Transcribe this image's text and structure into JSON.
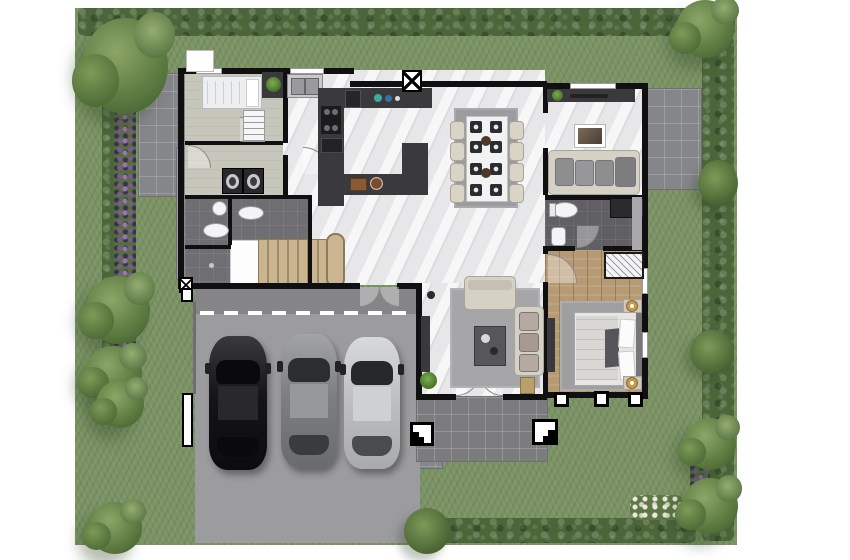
{
  "scene": {
    "type": "architectural-floor-plan",
    "view": "top-down",
    "description": "Rendered ground-floor plan of a detached house on a landscaped lawn plot with hedged borders, two stone patios, an entry porch and a three-car carport with driveway"
  },
  "palette": {
    "lawn": "#7b9364",
    "hedge": "#4b673a",
    "tree": "#5f7d43",
    "flowers_purple": "#7b5a8c",
    "flowers_white": "#e8e8e8",
    "wall": "#101012",
    "marble_floor": "#e7e7e9",
    "service_floor": "#c6c7ba",
    "bath_floor": "#6f6f73",
    "wood_floor": "#b59a74",
    "counter_dark": "#3a3a3d",
    "stairs": "#c9b58f",
    "garage": "#9c9c9f",
    "garage_inner": "#858588",
    "porch": "#7c7c7f",
    "rug": "#a6a6a9",
    "sofa_beige": "#d6d1c5",
    "cushion_gray": "#8e8e91",
    "car_black": "#1a1a1c",
    "car_gray": "#8a8b8d",
    "car_silver": "#c7c8ca",
    "plant_green": "#5d8f35",
    "lamp_gold": "#c59a4c",
    "dining_table": "#f2f2f3",
    "placemat": "#2c2c30"
  },
  "rooms": [
    {
      "id": "single-bedroom",
      "label": "Single bedroom",
      "features": [
        "single-bed",
        "shelf-unit",
        "dresser",
        "plant"
      ]
    },
    {
      "id": "laundry",
      "label": "Laundry room",
      "features": [
        "washing-machine",
        "washing-machine"
      ]
    },
    {
      "id": "bathroom",
      "label": "Bathroom",
      "features": [
        "round-basin",
        "toilet",
        "vanity-basin",
        "floor-drain"
      ]
    },
    {
      "id": "kitchen",
      "label": "Kitchen",
      "features": [
        "double-sink",
        "cooktop",
        "oven",
        "refrigerator",
        "appliance-counter",
        "island-counter",
        "food-trays"
      ]
    },
    {
      "id": "dining-area",
      "label": "Dining area",
      "features": [
        "eight-seat-table",
        "8-placemats",
        "2-centerpieces",
        "rug"
      ]
    },
    {
      "id": "tv-lounge",
      "label": "TV lounge",
      "features": [
        "console-shelf",
        "plant",
        "wall-art",
        "sofa-with-cushions"
      ]
    },
    {
      "id": "ensuite-bathroom",
      "label": "En-suite bathroom",
      "features": [
        "toilet",
        "basin",
        "shower"
      ]
    },
    {
      "id": "master-bedroom",
      "label": "Master bedroom",
      "features": [
        "double-bed",
        "pillows",
        "rug",
        "2-nightstand-lamps",
        "clothes-rack",
        "tv-console"
      ]
    },
    {
      "id": "living-room",
      "label": "Living room",
      "features": [
        "loveseat",
        "side-sofa",
        "coffee-table",
        "tv-console",
        "plant",
        "basket",
        "floor-lamp"
      ]
    },
    {
      "id": "staircase",
      "label": "Staircase",
      "features": [
        "landing",
        "treads",
        "curved-handrail"
      ]
    },
    {
      "id": "foyer-porch",
      "label": "Entry porch",
      "features": [
        "double-door",
        "step-marker-left",
        "step-marker-right",
        "porch-columns"
      ]
    },
    {
      "id": "carport",
      "label": "Carport & driveway",
      "features": [
        "garage-threshold",
        "black-car",
        "gray-car",
        "silver-car",
        "gate-posts"
      ]
    }
  ],
  "furniture_counts": {
    "dining_chairs": 8,
    "dining_placemats": 8,
    "washing_machines": 2,
    "cars": 3,
    "beds": 2,
    "toilets": 3,
    "sofas": 3,
    "step_markers": 2,
    "porch_columns": 3
  },
  "cars": [
    {
      "color_name": "black",
      "hex": "#1a1a1c"
    },
    {
      "color_name": "gray",
      "hex": "#8a8b8d"
    },
    {
      "color_name": "silver",
      "hex": "#c7c8ca"
    }
  ],
  "garden": {
    "label": "Garden",
    "hedges": [
      "top",
      "left",
      "right-shrub-band",
      "bottom"
    ],
    "flowerbeds": [
      "left-purple-strip",
      "right-purple-patch",
      "bottom-white-flowers"
    ],
    "patios": [
      "top-left-stone-patio",
      "right-stone-patio",
      "west-side-path"
    ],
    "tree_clusters": 7,
    "markers": [
      "ac-unit-x-box-top",
      "ac-unit-x-box-west",
      "ac-pad-top-left",
      "gate-post-west",
      "gate-stub-west",
      "side-step-pad"
    ]
  }
}
